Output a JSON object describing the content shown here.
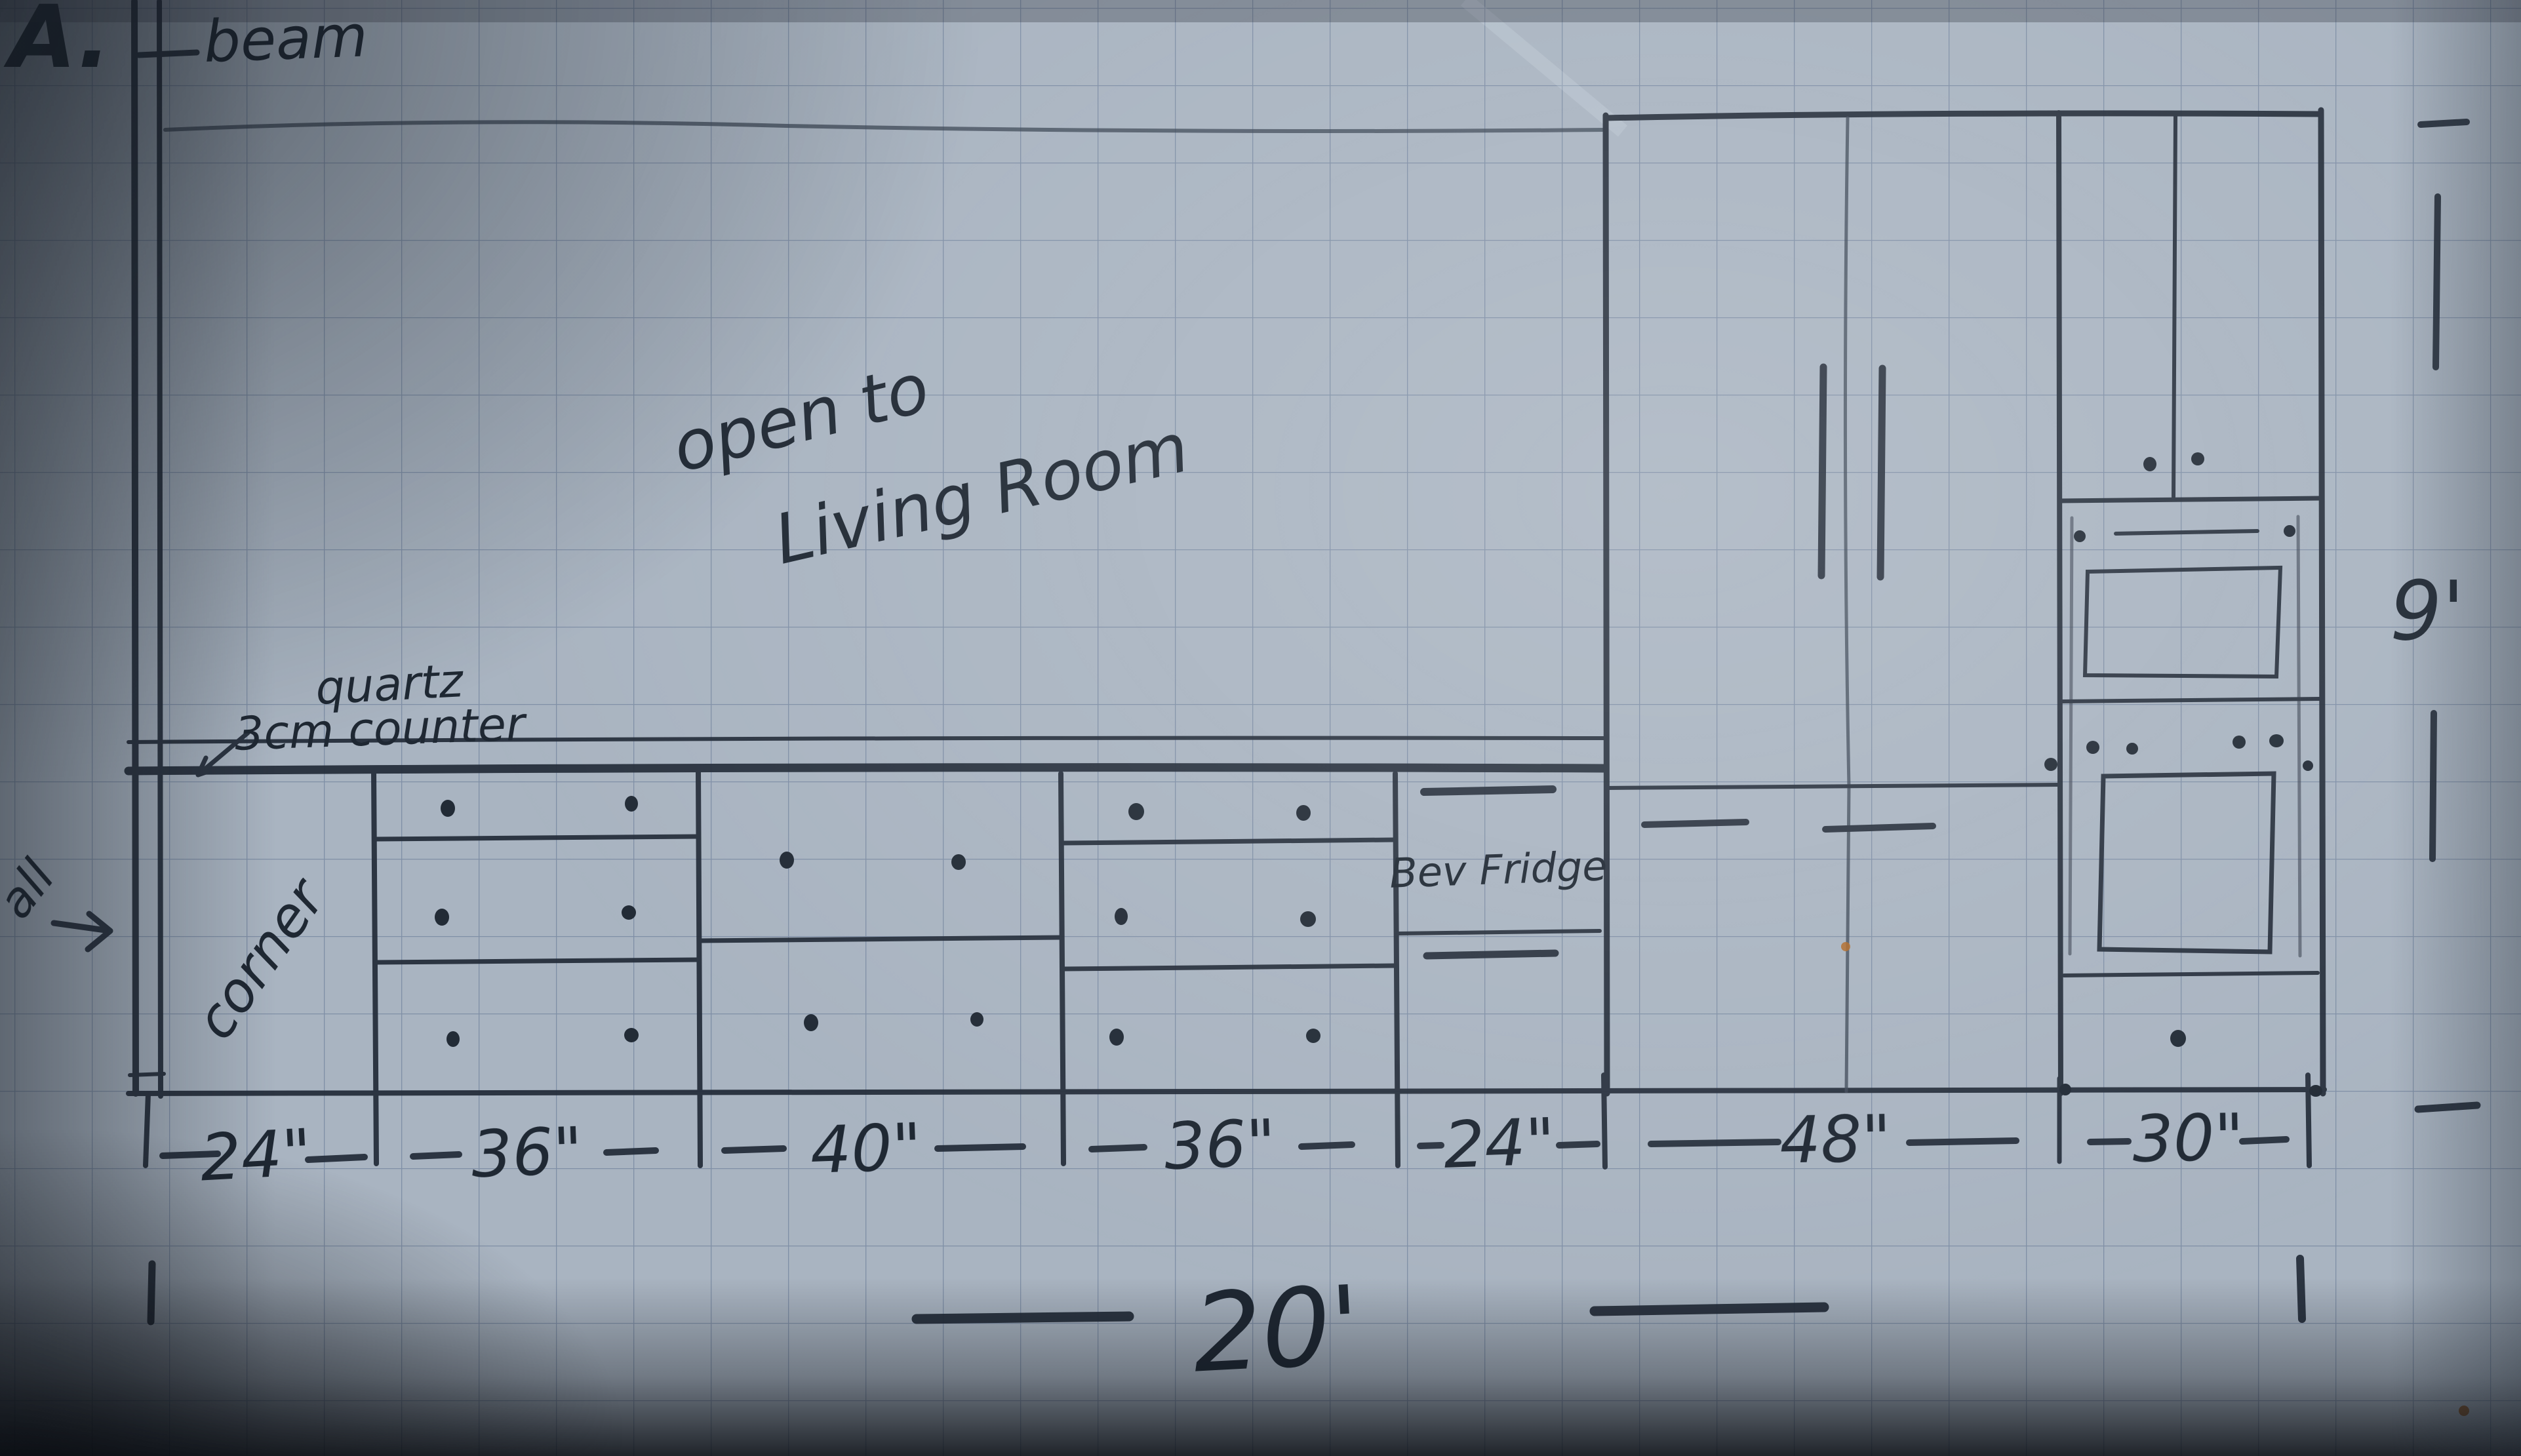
{
  "page": {
    "sheet_label": "A."
  },
  "annotations": {
    "beam": "beam",
    "open_to": "open to",
    "living_room": "Living Room",
    "quartz": "quartz",
    "counter": "3cm counter",
    "wall": "all",
    "corner": "corner",
    "bev_fridge": "Bev Fridge"
  },
  "dimensions": {
    "sections": [
      {
        "name": "corner-cabinet",
        "label": "24\""
      },
      {
        "name": "drawer-bank",
        "label": "36\""
      },
      {
        "name": "base-cabinet",
        "label": "40\""
      },
      {
        "name": "drawer-bank-2",
        "label": "36\""
      },
      {
        "name": "bev-fridge",
        "label": "24\""
      },
      {
        "name": "pantry",
        "label": "48\""
      },
      {
        "name": "oven-tower",
        "label": "30\""
      }
    ],
    "total_width": "20'",
    "ceiling_height": "9'"
  },
  "colors": {
    "ink": "#232c39",
    "paper": "#a9b4c1",
    "grid": "#56698c",
    "speck": "#b06a28"
  }
}
